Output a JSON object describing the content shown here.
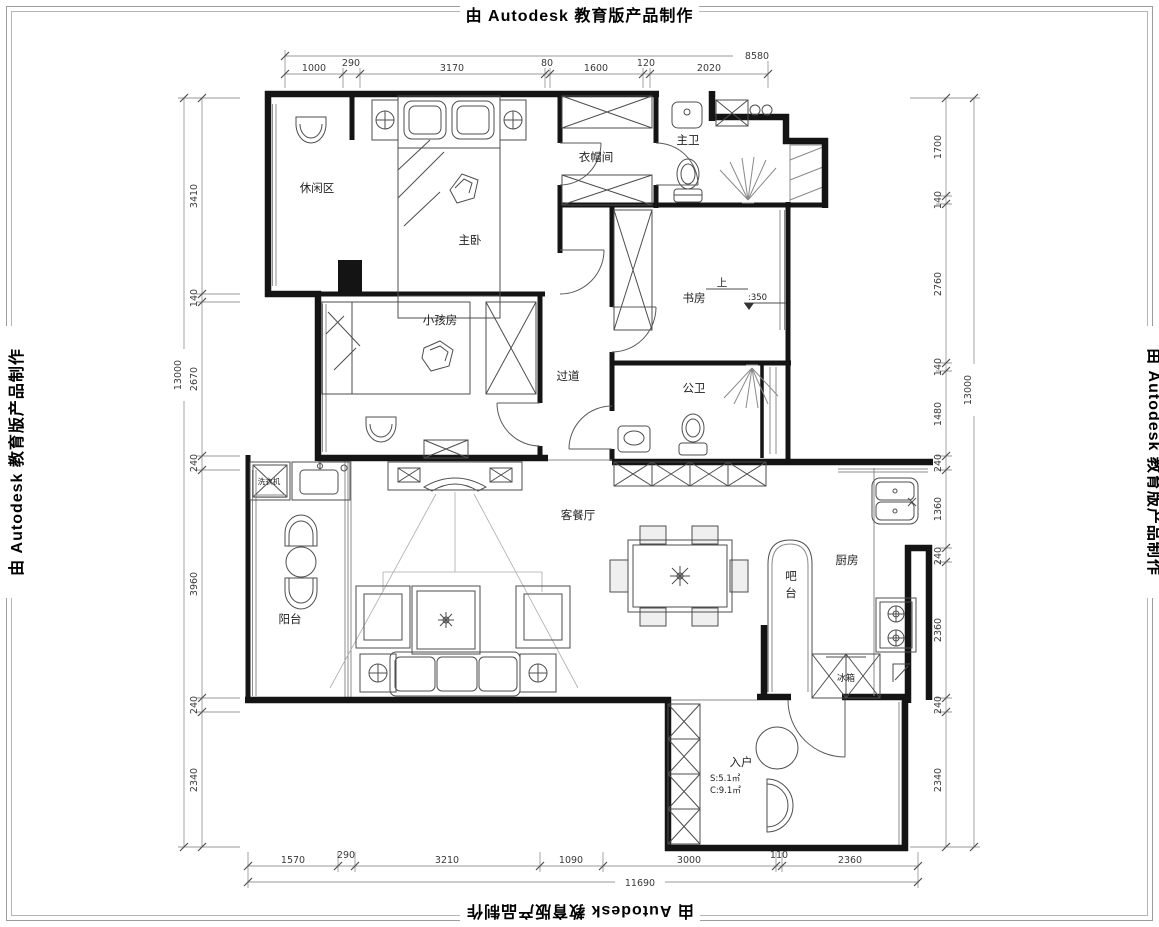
{
  "watermark": {
    "text": "由 Autodesk 教育版产品制作"
  },
  "rooms": {
    "leisure": "休闲区",
    "master_bedroom": "主卧",
    "cloakroom": "衣帽间",
    "master_bath": "主卫",
    "study": "书房",
    "kids_room": "小孩房",
    "corridor": "过道",
    "public_bath": "公卫",
    "living_dining": "客餐厅",
    "balcony": "阳台",
    "bar": "吧台",
    "kitchen": "厨房",
    "entry": "入户"
  },
  "labels": {
    "washing_machine": "洗衣机",
    "fridge": "冰箱",
    "up": "上",
    "level": ":350",
    "entry_area": "S:5.1㎡",
    "entry_girth": "C:9.1㎡"
  },
  "dims": {
    "top": {
      "total": "8580",
      "segments": [
        "1000",
        "290",
        "3170",
        "80",
        "1600",
        "120",
        "2020"
      ]
    },
    "left": {
      "total": "13000",
      "segments": [
        "3410",
        "140",
        "2670",
        "240",
        "3960",
        "240",
        "2340"
      ]
    },
    "right": {
      "total": "13000",
      "segments": [
        "1700",
        "140",
        "2760",
        "140",
        "1480",
        "240",
        "1360",
        "240",
        "2360",
        "240",
        "2340"
      ]
    },
    "bottom": {
      "total": "11690",
      "segments": [
        "1570",
        "290",
        "3210",
        "1090",
        "3000",
        "110",
        "2360"
      ]
    }
  }
}
